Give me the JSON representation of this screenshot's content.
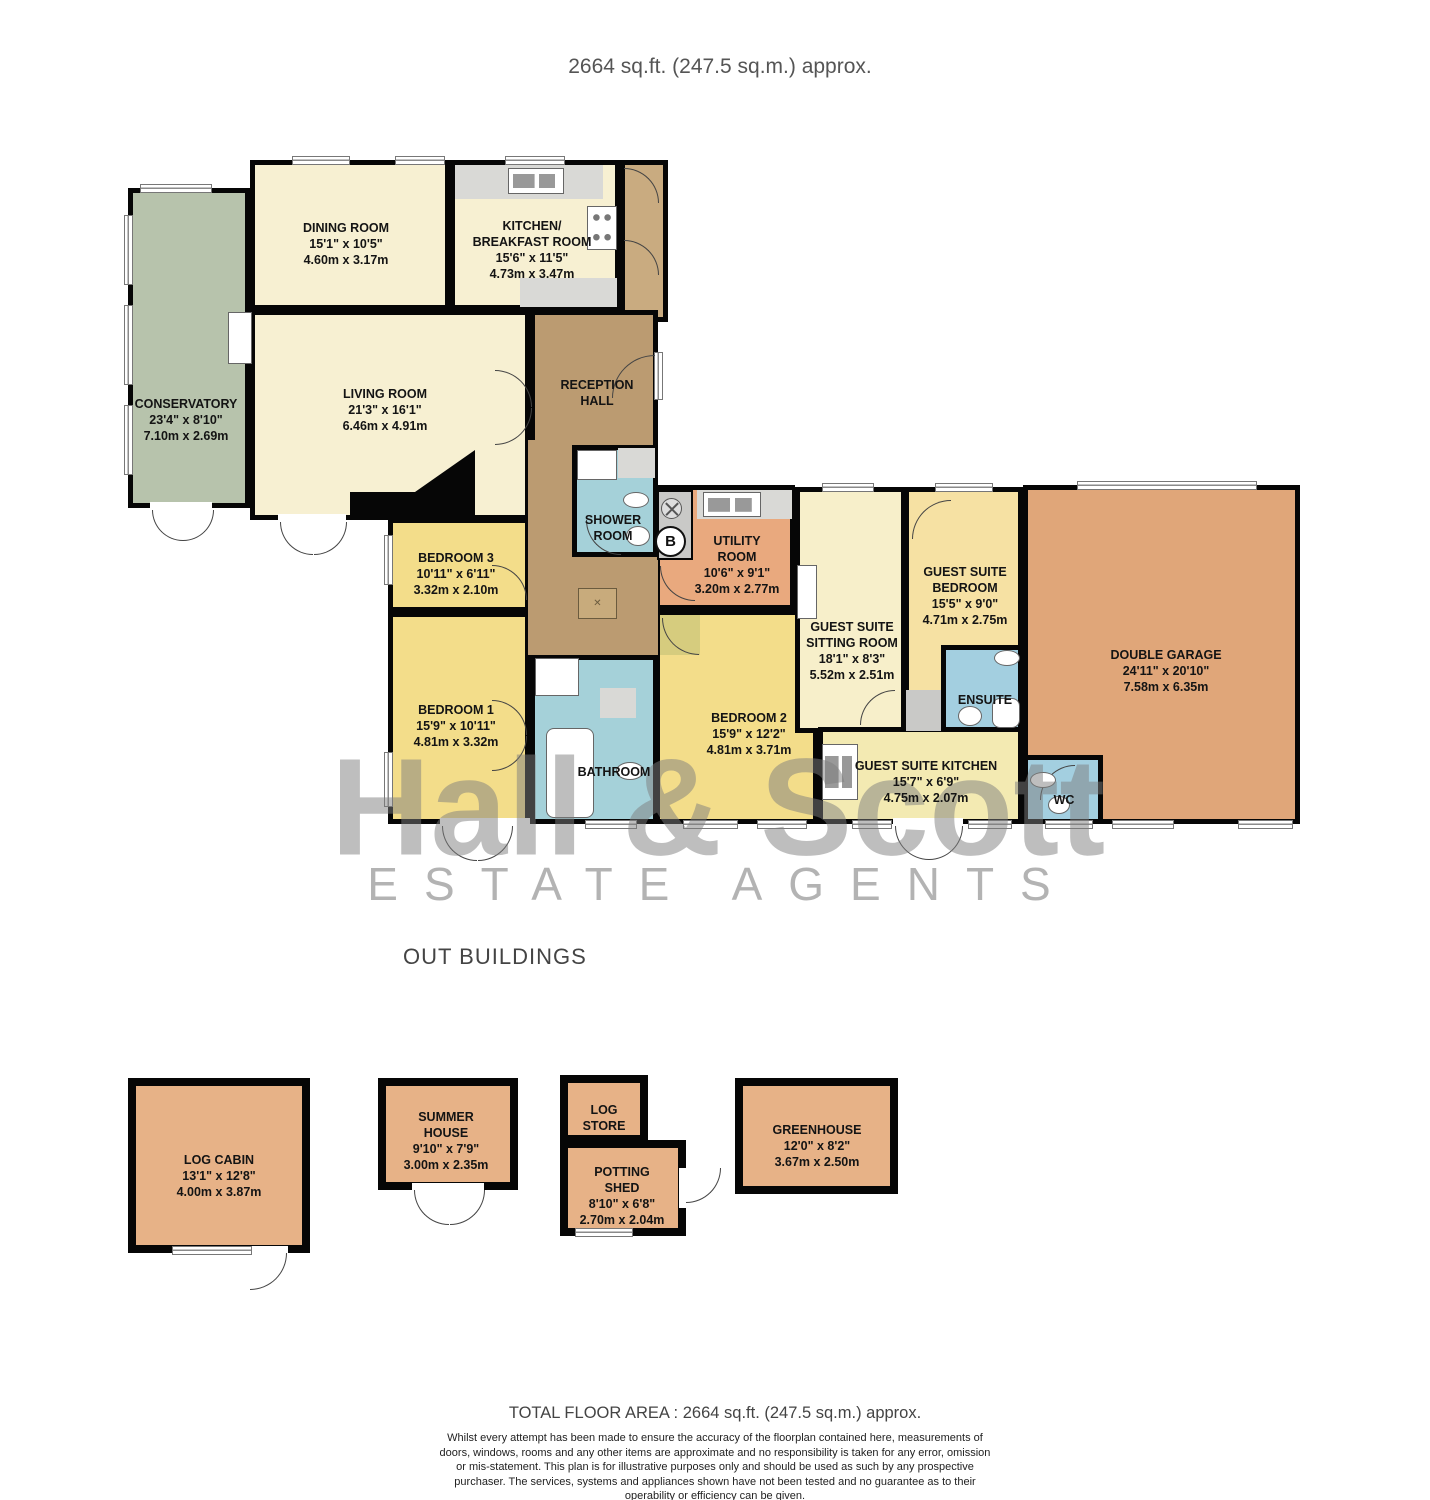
{
  "title": "2664 sq.ft. (247.5 sq.m.) approx.",
  "section_label": "OUT BUILDINGS",
  "watermark": {
    "line1": "Hall & Scott",
    "line2": "ESTATE AGENTS"
  },
  "symbols": {
    "boiler": "B",
    "hatch": "✕"
  },
  "rooms": {
    "conservatory": {
      "name": "CONSERVATORY",
      "dim_ft": "23'4\"  x 8'10\"",
      "dim_m": "7.10m  x 2.69m"
    },
    "dining": {
      "name": "DINING ROOM",
      "dim_ft": "15'1\"  x 10'5\"",
      "dim_m": "4.60m  x 3.17m"
    },
    "kitchen": {
      "name": "KITCHEN/\nBREAKFAST ROOM",
      "dim_ft": "15'6\"  x 11'5\"",
      "dim_m": "4.73m  x 3.47m"
    },
    "living": {
      "name": "LIVING ROOM",
      "dim_ft": "21'3\"  x 16'1\"",
      "dim_m": "6.46m  x 4.91m"
    },
    "reception": {
      "name": "RECEPTION\nHALL"
    },
    "shower": {
      "name": "SHOWER\nROOM"
    },
    "utility": {
      "name": "UTILITY\nROOM",
      "dim_ft": "10'6\"  x 9'1\"",
      "dim_m": "3.20m  x 2.77m"
    },
    "bedroom3": {
      "name": "BEDROOM 3",
      "dim_ft": "10'11\"  x 6'11\"",
      "dim_m": "3.32m  x 2.10m"
    },
    "bedroom1": {
      "name": "BEDROOM 1",
      "dim_ft": "15'9\"  x 10'11\"",
      "dim_m": "4.81m  x 3.32m"
    },
    "bathroom": {
      "name": "BATHROOM"
    },
    "bedroom2": {
      "name": "BEDROOM 2",
      "dim_ft": "15'9\"  x 12'2\"",
      "dim_m": "4.81m  x 3.71m"
    },
    "sitting": {
      "name": "GUEST SUITE\nSITTING ROOM",
      "dim_ft": "18'1\"  x 8'3\"",
      "dim_m": "5.52m  x 2.51m"
    },
    "guestbed": {
      "name": "GUEST SUITE\nBEDROOM",
      "dim_ft": "15'5\"  x 9'0\"",
      "dim_m": "4.71m  x 2.75m"
    },
    "ensuite": {
      "name": "ENSUITE"
    },
    "guestkitchen": {
      "name": "GUEST SUITE KITCHEN",
      "dim_ft": "15'7\"  x 6'9\"",
      "dim_m": "4.75m  x 2.07m"
    },
    "wc": {
      "name": "WC"
    },
    "garage": {
      "name": "DOUBLE GARAGE",
      "dim_ft": "24'11\"  x 20'10\"",
      "dim_m": "7.58m  x 6.35m"
    },
    "logcabin": {
      "name": "LOG CABIN",
      "dim_ft": "13'1\"  x 12'8\"",
      "dim_m": "4.00m  x 3.87m"
    },
    "summerhouse": {
      "name": "SUMMER\nHOUSE",
      "dim_ft": "9'10\"  x 7'9\"",
      "dim_m": "3.00m  x 2.35m"
    },
    "logstore": {
      "name": "LOG\nSTORE"
    },
    "pottingshed": {
      "name": "POTTING\nSHED",
      "dim_ft": "8'10\"  x 6'8\"",
      "dim_m": "2.70m  x 2.04m"
    },
    "greenhouse": {
      "name": "GREENHOUSE",
      "dim_ft": "12'0\"  x 8'2\"",
      "dim_m": "3.67m  x 2.50m"
    }
  },
  "footer": {
    "total": "TOTAL FLOOR AREA : 2664 sq.ft. (247.5 sq.m.) approx.",
    "disclaimer": "Whilst every attempt has been made to ensure the accuracy of the floorplan contained here, measurements of doors, windows, rooms and any other items are approximate and no responsibility is taken for any error, omission or mis-statement. This plan is for illustrative purposes only and should be used as such by any prospective purchaser. The services, systems and appliances shown have not been tested and no guarantee as to their operability or efficiency can be given.",
    "credit": "Made with Metropix ©2023"
  },
  "colors": {
    "wall": "#060606",
    "cream": "#f7f0d2",
    "conservatory": "#b7c3ac",
    "hall": "#bb9b71",
    "bath_blue": "#a5d1d9",
    "utility_salmon": "#e9a97e",
    "bedroom_yellow": "#f3dd8a",
    "garage_orange": "#e0a679",
    "outbuilding_orange": "#e7b287",
    "watermark_gray": "#9a9a9a"
  }
}
